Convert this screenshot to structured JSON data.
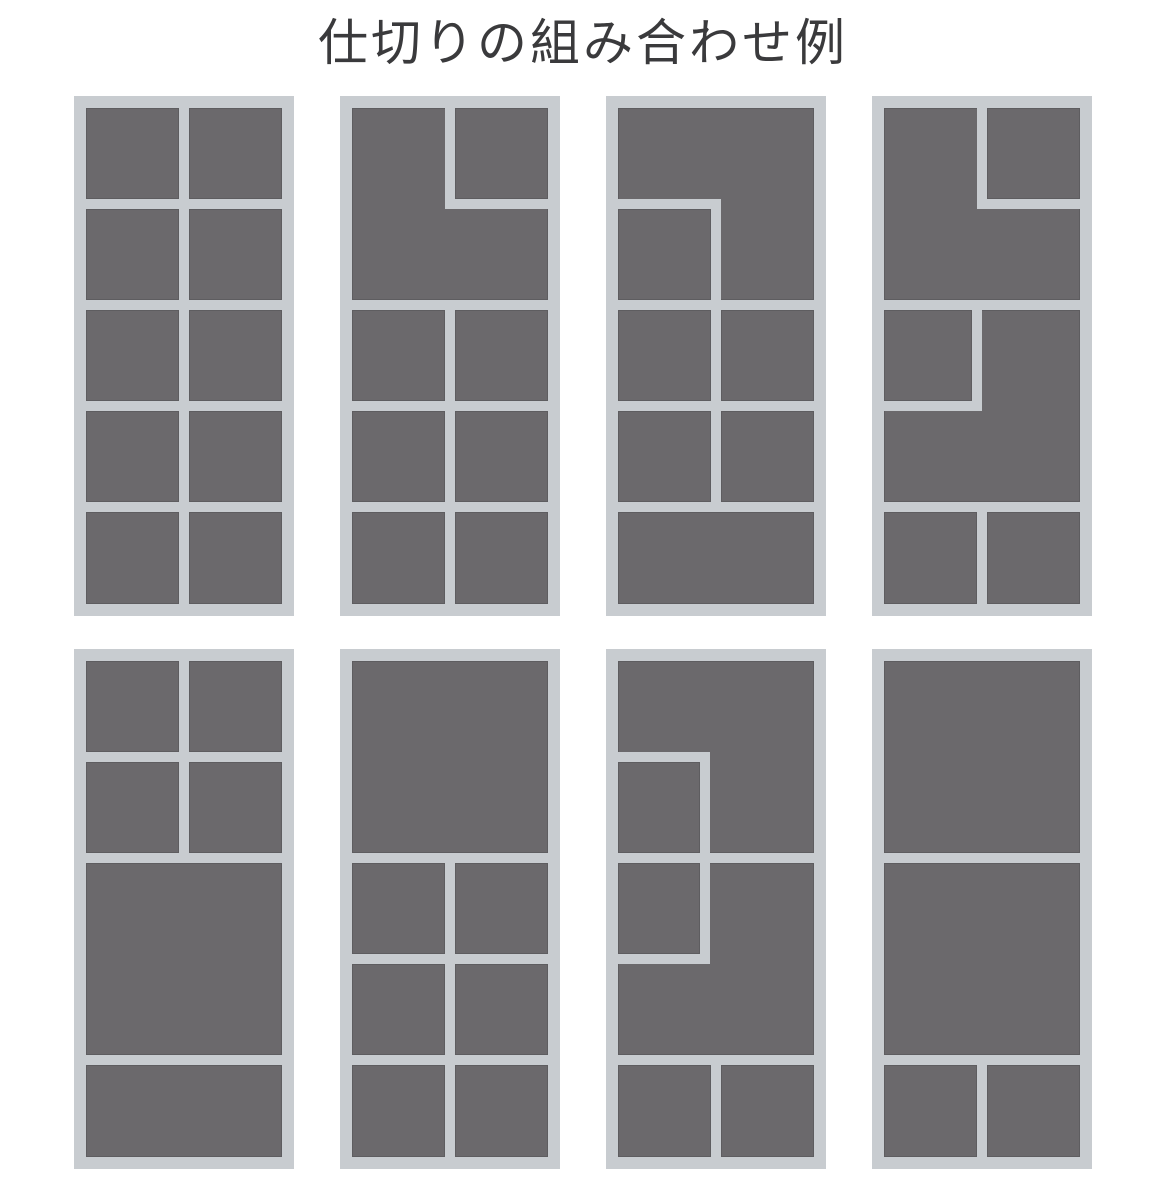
{
  "title": "仕切りの組み合わせ例",
  "colors": {
    "background": "#ffffff",
    "frame": "#c8ccd0",
    "cell": "#6b696c",
    "title": "#3a3a3c"
  },
  "panel_size": {
    "width": 220,
    "height": 520
  },
  "panels": [
    {
      "id": "panel-1-grid-2x5",
      "x": 74,
      "y": 96,
      "cells": [
        {
          "x": 12,
          "y": 12,
          "w": 93,
          "h": 91
        },
        {
          "x": 115,
          "y": 12,
          "w": 93,
          "h": 91
        },
        {
          "x": 12,
          "y": 113,
          "w": 93,
          "h": 91
        },
        {
          "x": 115,
          "y": 113,
          "w": 93,
          "h": 91
        },
        {
          "x": 12,
          "y": 214,
          "w": 93,
          "h": 91
        },
        {
          "x": 115,
          "y": 214,
          "w": 93,
          "h": 91
        },
        {
          "x": 12,
          "y": 315,
          "w": 93,
          "h": 91
        },
        {
          "x": 115,
          "y": 315,
          "w": 93,
          "h": 91
        },
        {
          "x": 12,
          "y": 416,
          "w": 93,
          "h": 92
        },
        {
          "x": 115,
          "y": 416,
          "w": 93,
          "h": 92
        }
      ]
    },
    {
      "id": "panel-2-ltop-grid-2x3",
      "x": 340,
      "y": 96,
      "cells": [
        {
          "x": 115,
          "y": 12,
          "w": 93,
          "h": 91
        },
        {
          "x": 12,
          "y": 12,
          "w": 196,
          "h": 192,
          "notch": {
            "corner": "tr",
            "w": 103,
            "h": 101
          }
        },
        {
          "x": 12,
          "y": 214,
          "w": 93,
          "h": 91
        },
        {
          "x": 115,
          "y": 214,
          "w": 93,
          "h": 91
        },
        {
          "x": 12,
          "y": 315,
          "w": 93,
          "h": 91
        },
        {
          "x": 115,
          "y": 315,
          "w": 93,
          "h": 91
        },
        {
          "x": 12,
          "y": 416,
          "w": 93,
          "h": 92
        },
        {
          "x": 115,
          "y": 416,
          "w": 93,
          "h": 92
        }
      ]
    },
    {
      "id": "panel-3-inverted-l-bottom-full",
      "x": 606,
      "y": 96,
      "cells": [
        {
          "x": 12,
          "y": 12,
          "w": 196,
          "h": 192,
          "notch": {
            "corner": "bl",
            "w": 103,
            "h": 101
          }
        },
        {
          "x": 12,
          "y": 113,
          "w": 93,
          "h": 91
        },
        {
          "x": 12,
          "y": 214,
          "w": 93,
          "h": 91
        },
        {
          "x": 115,
          "y": 214,
          "w": 93,
          "h": 91
        },
        {
          "x": 12,
          "y": 315,
          "w": 93,
          "h": 91
        },
        {
          "x": 115,
          "y": 315,
          "w": 93,
          "h": 91
        },
        {
          "x": 12,
          "y": 416,
          "w": 196,
          "h": 92
        }
      ]
    },
    {
      "id": "panel-4-double-l",
      "x": 872,
      "y": 96,
      "cells": [
        {
          "x": 115,
          "y": 12,
          "w": 93,
          "h": 91
        },
        {
          "x": 12,
          "y": 12,
          "w": 196,
          "h": 192,
          "notch": {
            "corner": "tr",
            "w": 103,
            "h": 101
          }
        },
        {
          "x": 12,
          "y": 214,
          "w": 88,
          "h": 91
        },
        {
          "x": 12,
          "y": 214,
          "w": 196,
          "h": 192,
          "notch": {
            "corner": "tl",
            "w": 98,
            "h": 101
          }
        },
        {
          "x": 12,
          "y": 416,
          "w": 93,
          "h": 92
        },
        {
          "x": 115,
          "y": 416,
          "w": 93,
          "h": 92
        }
      ]
    },
    {
      "id": "panel-5-grid-2x2-two-full",
      "x": 74,
      "y": 649,
      "cells": [
        {
          "x": 12,
          "y": 12,
          "w": 93,
          "h": 91
        },
        {
          "x": 115,
          "y": 12,
          "w": 93,
          "h": 91
        },
        {
          "x": 12,
          "y": 113,
          "w": 93,
          "h": 91
        },
        {
          "x": 115,
          "y": 113,
          "w": 93,
          "h": 91
        },
        {
          "x": 12,
          "y": 214,
          "w": 196,
          "h": 192
        },
        {
          "x": 12,
          "y": 416,
          "w": 196,
          "h": 92
        }
      ]
    },
    {
      "id": "panel-6-big-top-grid-2x3",
      "x": 340,
      "y": 649,
      "cells": [
        {
          "x": 12,
          "y": 12,
          "w": 196,
          "h": 192
        },
        {
          "x": 12,
          "y": 214,
          "w": 93,
          "h": 91
        },
        {
          "x": 115,
          "y": 214,
          "w": 93,
          "h": 91
        },
        {
          "x": 12,
          "y": 315,
          "w": 93,
          "h": 91
        },
        {
          "x": 115,
          "y": 315,
          "w": 93,
          "h": 91
        },
        {
          "x": 12,
          "y": 416,
          "w": 93,
          "h": 92
        },
        {
          "x": 115,
          "y": 416,
          "w": 93,
          "h": 92
        }
      ]
    },
    {
      "id": "panel-7-double-l-narrow",
      "x": 606,
      "y": 649,
      "cells": [
        {
          "x": 12,
          "y": 12,
          "w": 196,
          "h": 192,
          "notch": {
            "corner": "bl",
            "w": 92,
            "h": 101
          }
        },
        {
          "x": 12,
          "y": 113,
          "w": 82,
          "h": 91
        },
        {
          "x": 12,
          "y": 214,
          "w": 82,
          "h": 91
        },
        {
          "x": 12,
          "y": 214,
          "w": 196,
          "h": 192,
          "notch": {
            "corner": "tl",
            "w": 92,
            "h": 101
          }
        },
        {
          "x": 12,
          "y": 416,
          "w": 93,
          "h": 92
        },
        {
          "x": 115,
          "y": 416,
          "w": 93,
          "h": 92
        }
      ]
    },
    {
      "id": "panel-8-two-big-two-small",
      "x": 872,
      "y": 649,
      "cells": [
        {
          "x": 12,
          "y": 12,
          "w": 196,
          "h": 192
        },
        {
          "x": 12,
          "y": 214,
          "w": 196,
          "h": 192
        },
        {
          "x": 12,
          "y": 416,
          "w": 93,
          "h": 92
        },
        {
          "x": 115,
          "y": 416,
          "w": 93,
          "h": 92
        }
      ]
    }
  ]
}
